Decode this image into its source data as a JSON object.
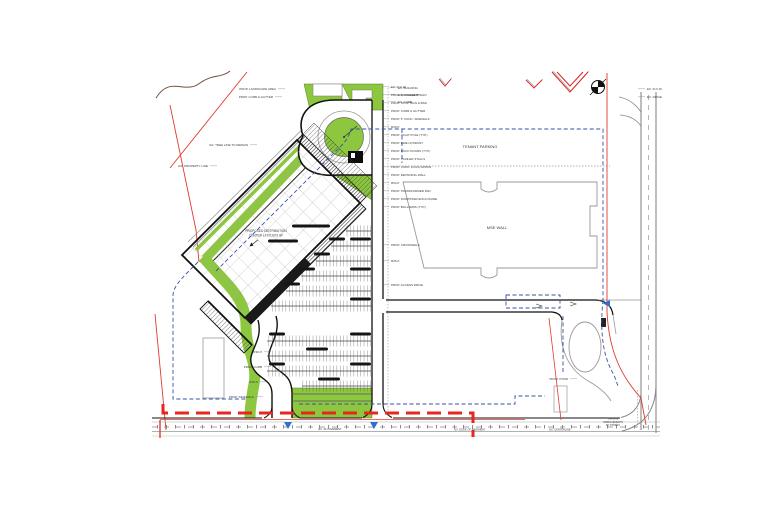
{
  "drawing": {
    "type": "civil-site-plan",
    "building": {
      "line1": "PROPOSED DISTRIBUTION",
      "line2": "CENTER ±XXX,XXX SF"
    },
    "tenant_parking_label": "TENANT PARKING",
    "mse_wall_label": "MSE WALL",
    "corner_note": [
      "OFFSITE",
      "IMPROVEMENTS",
      "BY OTHERS"
    ],
    "colors": {
      "landscape_green": "#8dc63f",
      "landscape_edge": "#4e7d21",
      "phase_line_red": "#e8251f",
      "boundary_red": "#e03a2f",
      "utility_blue": "#3a52a0",
      "flow_arrow_blue": "#2f6fd0",
      "road_gray": "#999999",
      "line_black": "#111111"
    }
  },
  "callouts": {
    "right": [
      {
        "x": 391,
        "y": 88,
        "a": "start",
        "t": "EX. R.O.W."
      },
      {
        "x": 391,
        "y": 96,
        "a": "start",
        "t": "PROP. MONUMENT SIGN"
      },
      {
        "x": 391,
        "y": 104,
        "a": "start",
        "t": "PROP. STOP SIGN & BAR"
      },
      {
        "x": 391,
        "y": 112,
        "a": "start",
        "t": "PROP. CURB & GUTTER"
      },
      {
        "x": 391,
        "y": 120,
        "a": "start",
        "t": "PROP. 5' CONC. SIDEWALK"
      },
      {
        "x": 391,
        "y": 128,
        "a": "start",
        "t": "R30.0'"
      },
      {
        "x": 391,
        "y": 136,
        "a": "start",
        "t": "PROP. LIGHT POLE (TYP.)"
      },
      {
        "x": 391,
        "y": 144,
        "a": "start",
        "t": "PROP. FIRE HYDRANT"
      },
      {
        "x": 391,
        "y": 152,
        "a": "start",
        "t": "PROP. DOCK DOORS (TYP.)"
      },
      {
        "x": 391,
        "y": 160,
        "a": "start",
        "t": "PROP. TRAILER STALLS"
      },
      {
        "x": 391,
        "y": 168,
        "a": "start",
        "t": "PROP. CONC. DOCK APRON"
      },
      {
        "x": 391,
        "y": 176,
        "a": "start",
        "t": "PROP. RETAINING WALL"
      },
      {
        "x": 391,
        "y": 184,
        "a": "start",
        "t": "R54.0'"
      },
      {
        "x": 391,
        "y": 192,
        "a": "start",
        "t": "PROP. TRANSFORMER PAD"
      },
      {
        "x": 391,
        "y": 200,
        "a": "start",
        "t": "PROP. DUMPSTER ENCLOSURE"
      },
      {
        "x": 391,
        "y": 208,
        "a": "start",
        "t": "PROP. BOLLARDS (TYP.)"
      },
      {
        "x": 391,
        "y": 246,
        "a": "start",
        "t": "PROP. CROSSWALK"
      },
      {
        "x": 391,
        "y": 262,
        "a": "start",
        "t": "R25.0'"
      },
      {
        "x": 391,
        "y": 286,
        "a": "start",
        "t": "PROP. ACCESS DRIVE"
      }
    ],
    "misc": [
      {
        "x": 276,
        "y": 90,
        "a": "end",
        "t": "PROP. LANDSCAPE AREA"
      },
      {
        "x": 273,
        "y": 98,
        "a": "end",
        "t": "PROP. CURB & GUTTER"
      },
      {
        "x": 248,
        "y": 146,
        "a": "end",
        "t": "EX. TREE LINE TO REMAIN"
      },
      {
        "x": 208,
        "y": 167,
        "a": "end",
        "t": "EX. PROPERTY LINE"
      },
      {
        "x": 262,
        "y": 353,
        "a": "end",
        "t": "R30.0'"
      },
      {
        "x": 262,
        "y": 368,
        "a": "end",
        "t": "PROP. CURB"
      },
      {
        "x": 258,
        "y": 383,
        "a": "end",
        "t": "R10.0'"
      },
      {
        "x": 254,
        "y": 398,
        "a": "end",
        "t": "PROP. SIDEWALK"
      },
      {
        "x": 398,
        "y": 89,
        "a": "start",
        "t": "EX. BUILDING"
      },
      {
        "x": 398,
        "y": 96,
        "a": "start",
        "t": "EX. PAVEMENT"
      },
      {
        "x": 398,
        "y": 103,
        "a": "start",
        "t": "EX. CURB"
      },
      {
        "x": 647,
        "y": 90,
        "a": "start",
        "t": "EX. R.O.W."
      },
      {
        "x": 647,
        "y": 98,
        "a": "start",
        "t": "EX. DRIVE"
      },
      {
        "x": 568,
        "y": 380,
        "a": "end",
        "t": "PROP. POND"
      }
    ],
    "road": [
      {
        "x": 330,
        "y": 430,
        "t": "EX. 24' PAVEMENT"
      },
      {
        "x": 470,
        "y": 430.5,
        "t": "EX. EDGE OF PAVEMENT"
      },
      {
        "x": 560,
        "y": 430.5,
        "t": "EX. CENTERLINE"
      }
    ]
  },
  "parking": {
    "rows": [
      {
        "y": 231,
        "x1": 346,
        "x2": 371
      },
      {
        "y": 246,
        "x1": 331,
        "x2": 371
      },
      {
        "y": 261,
        "x1": 316,
        "x2": 371
      },
      {
        "y": 276,
        "x1": 301,
        "x2": 371
      },
      {
        "y": 291,
        "x1": 286,
        "x2": 371
      },
      {
        "y": 306,
        "x1": 271,
        "x2": 371
      },
      {
        "y": 341,
        "x1": 267,
        "x2": 371
      },
      {
        "y": 356,
        "x1": 267,
        "x2": 371
      },
      {
        "y": 371,
        "x1": 267,
        "x2": 371
      },
      {
        "y": 386,
        "x1": 302,
        "x2": 371
      }
    ],
    "islands": [
      {
        "x": 292,
        "y": 226,
        "w": 38
      },
      {
        "x": 268,
        "y": 241,
        "w": 30
      },
      {
        "x": 350,
        "y": 239,
        "w": 21
      },
      {
        "x": 350,
        "y": 269,
        "w": 21
      },
      {
        "x": 350,
        "y": 299,
        "w": 21
      },
      {
        "x": 350,
        "y": 334,
        "w": 21
      },
      {
        "x": 350,
        "y": 364,
        "w": 21
      },
      {
        "x": 329,
        "y": 239,
        "w": 16
      },
      {
        "x": 314,
        "y": 254,
        "w": 16
      },
      {
        "x": 299,
        "y": 269,
        "w": 16
      },
      {
        "x": 284,
        "y": 284,
        "w": 16
      },
      {
        "x": 269,
        "y": 334,
        "w": 16
      },
      {
        "x": 269,
        "y": 364,
        "w": 16
      },
      {
        "x": 306,
        "y": 349,
        "w": 22
      },
      {
        "x": 318,
        "y": 379,
        "w": 22
      }
    ]
  }
}
